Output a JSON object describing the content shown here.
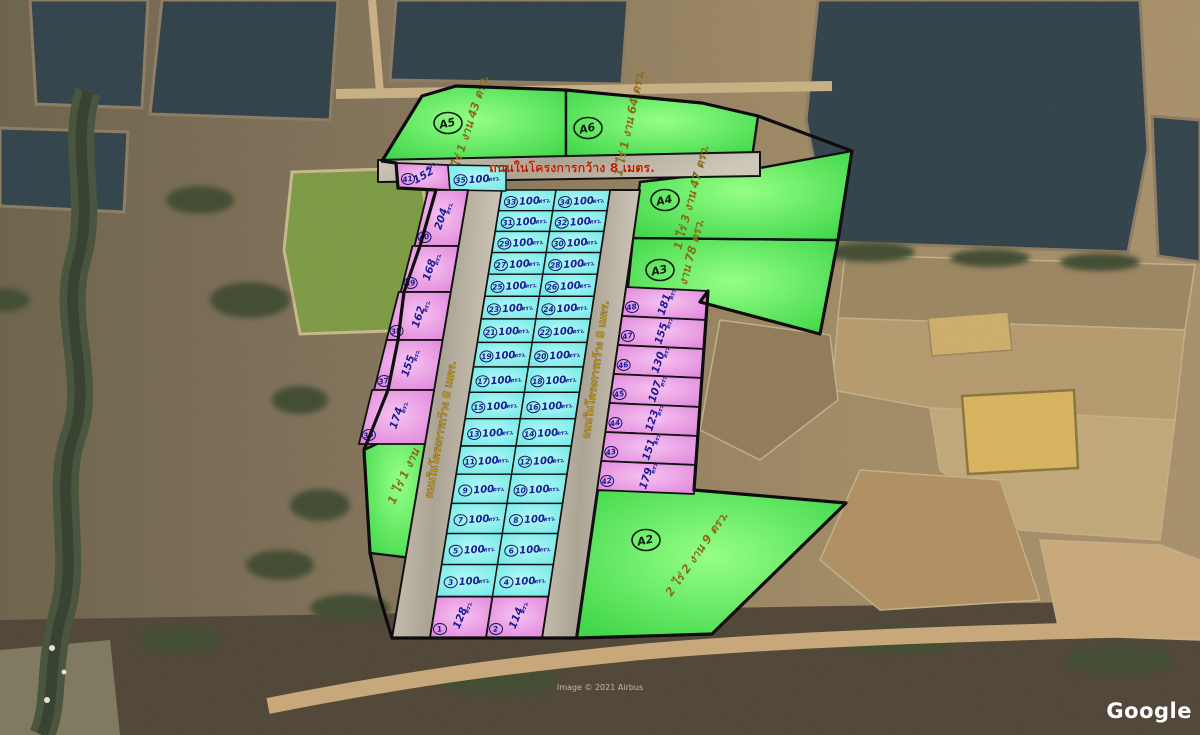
{
  "watermark": {
    "brand": "Google",
    "attribution": "Image © 2021 Airbus"
  },
  "overlay": {
    "road_label": "ถนนในโครงการกว้าง 8 เมตร.",
    "area_unit": "ตรว.",
    "colors": {
      "plot_green": "#4fdf52",
      "plot_pink": "#e792e2",
      "plot_cyan": "#7deeec",
      "road_fill": "#bdb6a9",
      "boundary": "#111111",
      "road_text_red": "#b5200f",
      "label_gold": "#8a6b1a",
      "value_navy": "#1b1b96"
    },
    "large_plots": [
      {
        "id": "A1",
        "size_label": "1 ไร่ 1 งาน"
      },
      {
        "id": "A2",
        "size_label": "2 ไร่ 2 งาน 9 ตรว."
      },
      {
        "id": "A3",
        "size_label": "1 ไร่ 3 งาน 78 ตรว."
      },
      {
        "id": "A4",
        "size_label": "1 ไร่ 3 งาน 47 ตรว."
      },
      {
        "id": "A5",
        "size_label": "1 ไร่ 1 งาน 43 ตรว."
      },
      {
        "id": "A6",
        "size_label": "1 ไร่ 1 งาน 64 ตรว."
      }
    ],
    "plots": [
      {
        "no": 1,
        "area": 128
      },
      {
        "no": 2,
        "area": 114
      },
      {
        "no": 3,
        "area": 100
      },
      {
        "no": 4,
        "area": 100
      },
      {
        "no": 5,
        "area": 100
      },
      {
        "no": 6,
        "area": 100
      },
      {
        "no": 7,
        "area": 100
      },
      {
        "no": 8,
        "area": 100
      },
      {
        "no": 9,
        "area": 100
      },
      {
        "no": 10,
        "area": 100
      },
      {
        "no": 11,
        "area": 100
      },
      {
        "no": 12,
        "area": 100
      },
      {
        "no": 13,
        "area": 100
      },
      {
        "no": 14,
        "area": 100
      },
      {
        "no": 15,
        "area": 100
      },
      {
        "no": 16,
        "area": 100
      },
      {
        "no": 17,
        "area": 100
      },
      {
        "no": 18,
        "area": 100
      },
      {
        "no": 19,
        "area": 100
      },
      {
        "no": 20,
        "area": 100
      },
      {
        "no": 21,
        "area": 100
      },
      {
        "no": 22,
        "area": 100
      },
      {
        "no": 23,
        "area": 100
      },
      {
        "no": 24,
        "area": 100
      },
      {
        "no": 25,
        "area": 100
      },
      {
        "no": 26,
        "area": 100
      },
      {
        "no": 27,
        "area": 100
      },
      {
        "no": 28,
        "area": 100
      },
      {
        "no": 29,
        "area": 100
      },
      {
        "no": 30,
        "area": 100
      },
      {
        "no": 31,
        "area": 100
      },
      {
        "no": 32,
        "area": 100
      },
      {
        "no": 33,
        "area": 100
      },
      {
        "no": 34,
        "area": 100
      },
      {
        "no": 35,
        "area": 100
      },
      {
        "no": 36,
        "area": 174
      },
      {
        "no": 37,
        "area": 155
      },
      {
        "no": 38,
        "area": 162
      },
      {
        "no": 39,
        "area": 168
      },
      {
        "no": 40,
        "area": 204
      },
      {
        "no": 41,
        "area": 152
      },
      {
        "no": 42,
        "area": 179
      },
      {
        "no": 43,
        "area": 151
      },
      {
        "no": 44,
        "area": 123
      },
      {
        "no": 45,
        "area": 107
      },
      {
        "no": 46,
        "area": 130
      },
      {
        "no": 47,
        "area": 155
      },
      {
        "no": 48,
        "area": 181
      }
    ]
  }
}
